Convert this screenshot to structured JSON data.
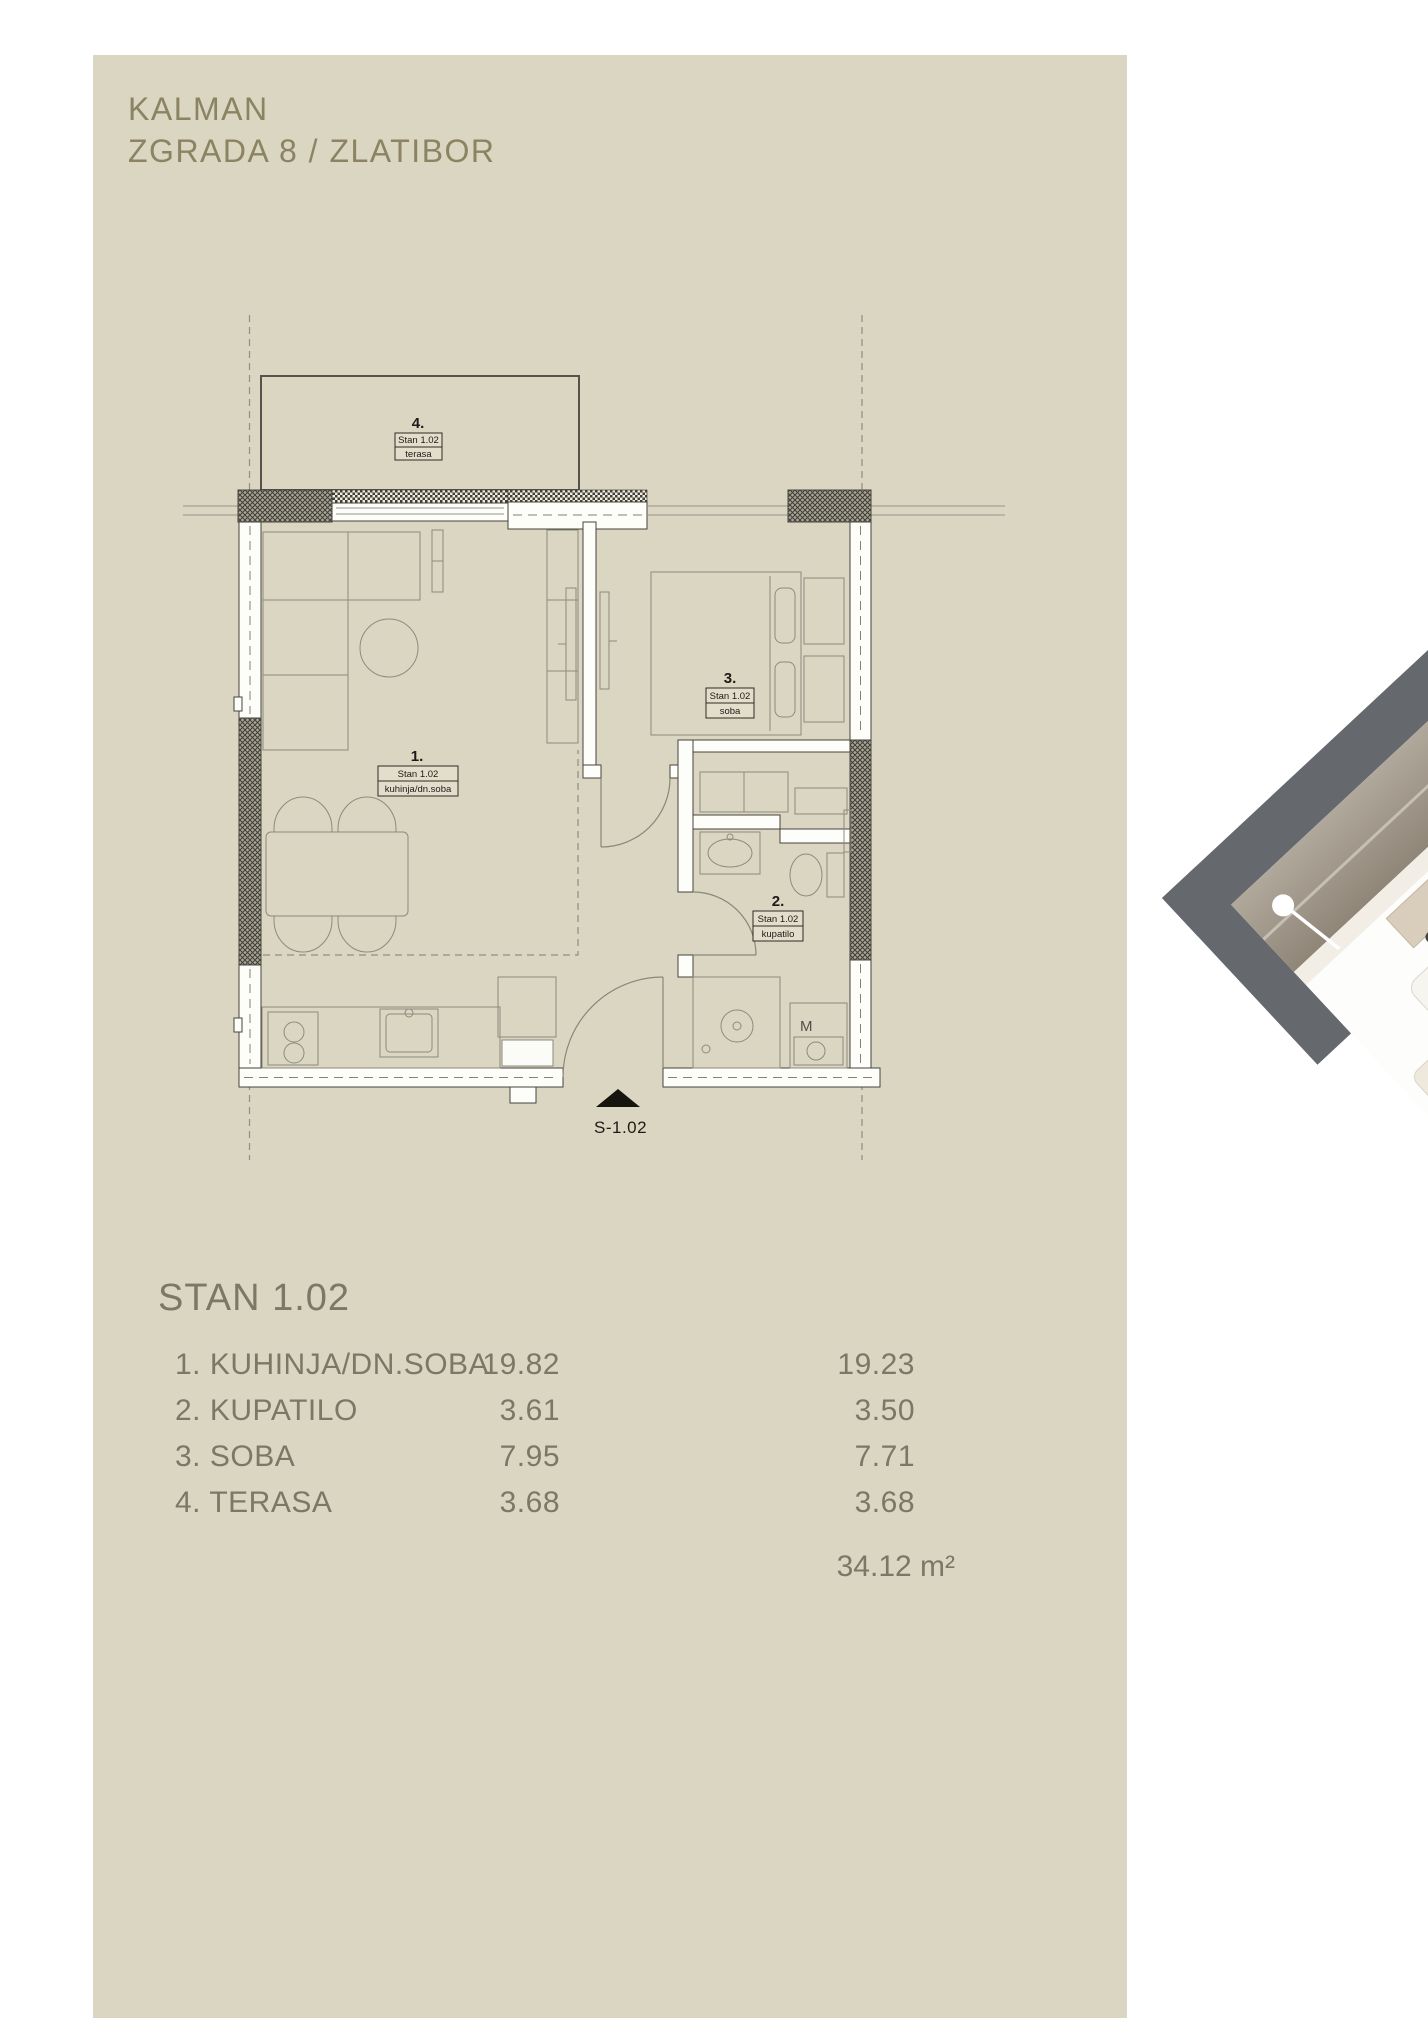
{
  "header": {
    "title_line1": "KALMAN",
    "title_line2": "ZGRADA 8 / ZLATIBOR"
  },
  "plan": {
    "rooms": [
      {
        "num": "1.",
        "unit": "Stan 1.02",
        "name": "kuhinja/dn.soba"
      },
      {
        "num": "2.",
        "unit": "Stan 1.02",
        "name": "kupatilo"
      },
      {
        "num": "3.",
        "unit": "Stan 1.02",
        "name": "soba"
      },
      {
        "num": "4.",
        "unit": "Stan 1.02",
        "name": "terasa"
      }
    ],
    "entrance_label": "S-1.02",
    "washer_label": "M"
  },
  "summary": {
    "title": "STAN 1.02",
    "rows": [
      {
        "label": "1. KUHINJA/DN.SOBA",
        "area": "19.82",
        "area2": "19.23"
      },
      {
        "label": "2. KUPATILO",
        "area": "3.61",
        "area2": "3.50"
      },
      {
        "label": "3. SOBA",
        "area": "7.95",
        "area2": "7.71"
      },
      {
        "label": "4. TERASA",
        "area": "3.68",
        "area2": "3.68"
      }
    ],
    "total": "34.12 m²"
  },
  "colors": {
    "panel": "#dad6c2",
    "title_text": "#8b8362",
    "table_text": "#7c7865",
    "plan_lines": "#8e8b7d",
    "wall_stroke": "#45433c",
    "render_dark": "#65696e",
    "render_wall": "#a79e91"
  }
}
